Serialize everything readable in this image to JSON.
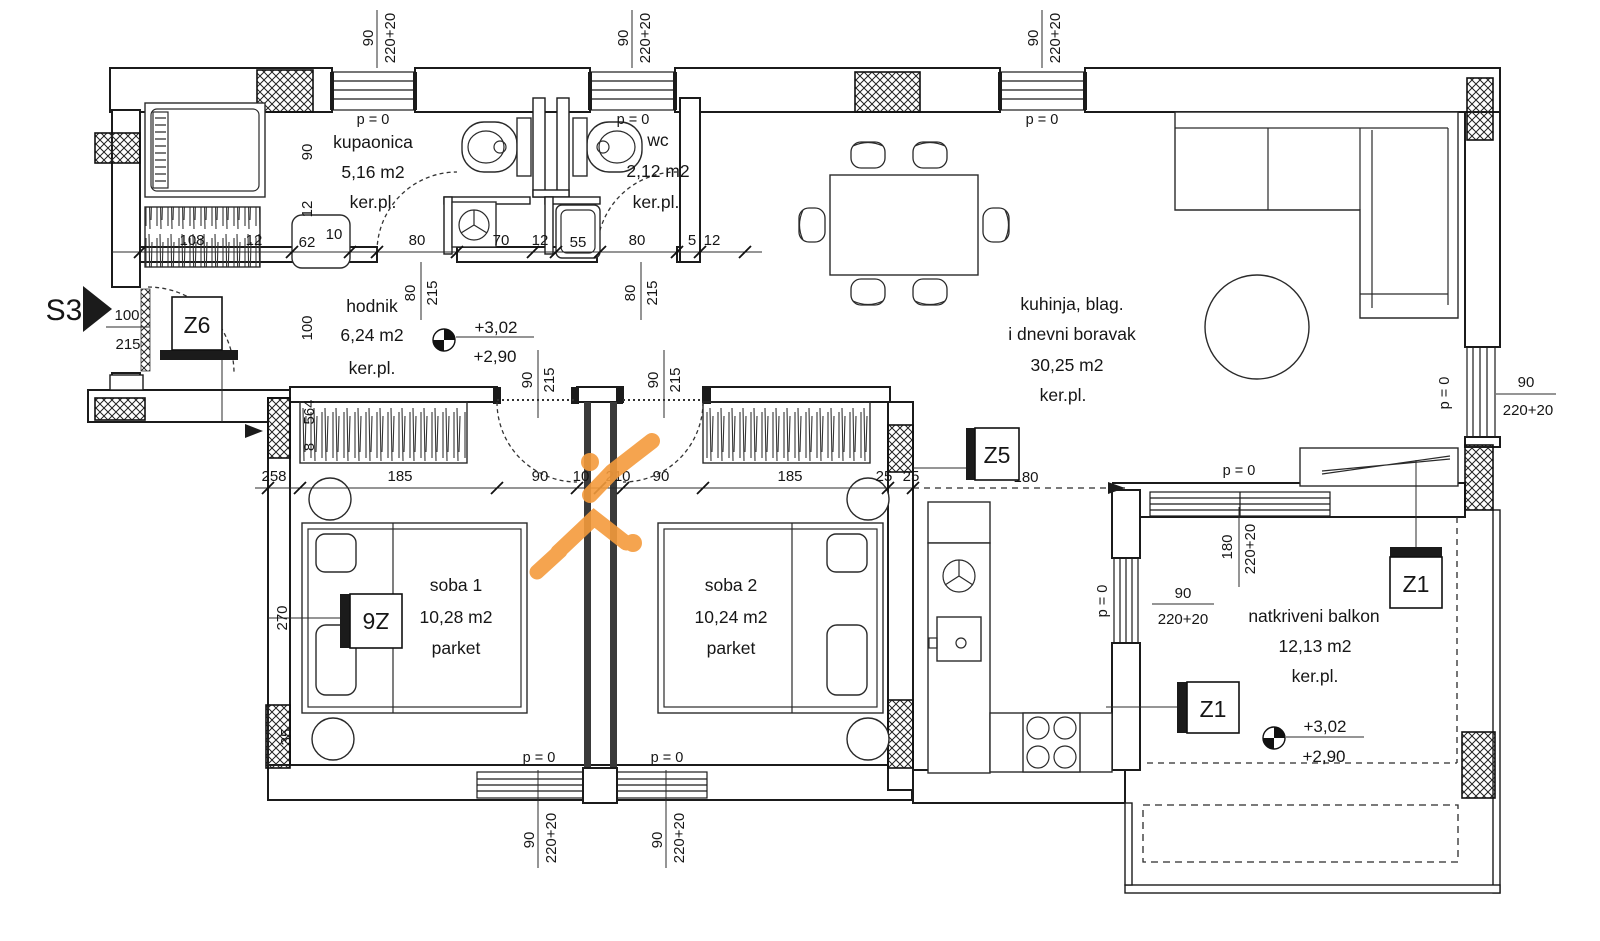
{
  "plan": {
    "type": "apartment floor plan",
    "watermark_color": "#F49B3C"
  },
  "rooms": {
    "kupaonica": {
      "name": "kupaonica",
      "area": "5,16 m2",
      "floor": "ker.pl."
    },
    "wc": {
      "name": "wc",
      "area": "2,12 m2",
      "floor": "ker.pl."
    },
    "hodnik": {
      "name": "hodnik",
      "area": "6,24 m2",
      "floor": "ker.pl."
    },
    "living": {
      "name_line1": "kuhinja, blag.",
      "name_line2": "i dnevni boravak",
      "area": "30,25 m2",
      "floor": "ker.pl."
    },
    "soba1": {
      "name": "soba 1",
      "area": "10,28 m2",
      "floor": "parket"
    },
    "soba2": {
      "name": "soba 2",
      "area": "10,24 m2",
      "floor": "parket"
    },
    "balkon": {
      "name": "natkriveni balkon",
      "area": "12,13 m2",
      "floor": "ker.pl."
    }
  },
  "levels": {
    "upper": "+3,02",
    "lower": "+2,90"
  },
  "labels": {
    "p0": "p = 0"
  },
  "markers": {
    "s3": "S3",
    "z1": "Z1",
    "z5": "Z5",
    "z6": "Z6"
  },
  "dims": {
    "w90": "90",
    "wh220": "220+20",
    "h215": "215",
    "d180": "180",
    "d80": "80",
    "d70": "70",
    "d55": "55",
    "d62": "62",
    "d12": "12",
    "d10": "10",
    "d5": "5",
    "d108": "108",
    "d100": "100",
    "d185": "185",
    "d258": "258",
    "d210": "210",
    "d25": "25",
    "d270": "270",
    "d35": "35",
    "d564": "564",
    "d8": "8"
  }
}
